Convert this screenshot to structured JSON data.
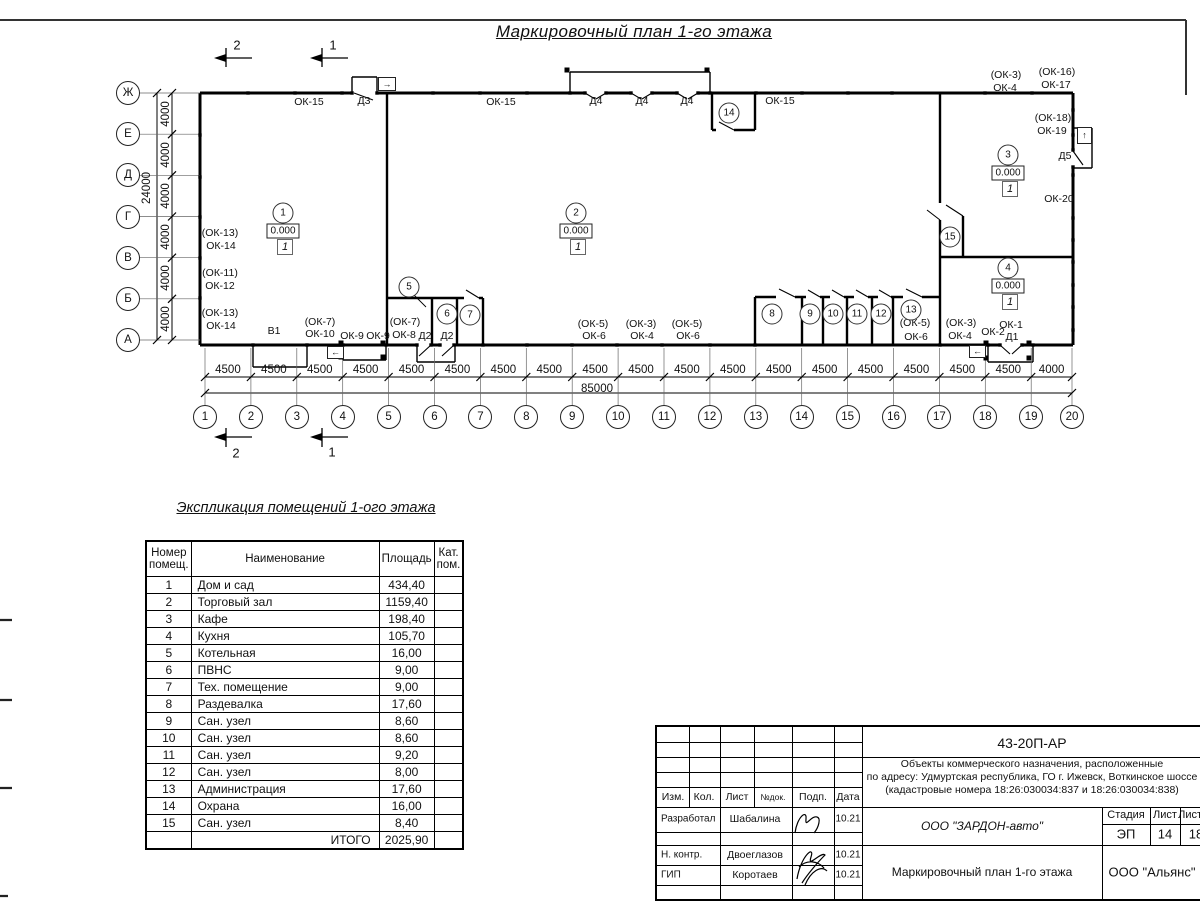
{
  "sheet": {
    "title": "Маркировочный план 1-го этажа"
  },
  "plan": {
    "section_marks": [
      {
        "label": "2",
        "x": 237,
        "y": 45
      },
      {
        "label": "1",
        "x": 333,
        "y": 45
      },
      {
        "label": "2",
        "x": 236,
        "y": 453
      },
      {
        "label": "1",
        "x": 332,
        "y": 452
      }
    ],
    "axes_left": [
      "Ж",
      "Е",
      "Д",
      "Г",
      "В",
      "Б",
      "А"
    ],
    "axes_bottom": [
      "1",
      "2",
      "3",
      "4",
      "5",
      "6",
      "7",
      "8",
      "9",
      "10",
      "11",
      "12",
      "13",
      "14",
      "15",
      "16",
      "17",
      "18",
      "19",
      "20"
    ],
    "dims_bottom": [
      "4500",
      "4500",
      "4500",
      "4500",
      "4500",
      "4500",
      "4500",
      "4500",
      "4500",
      "4500",
      "4500",
      "4500",
      "4500",
      "4500",
      "4500",
      "4500",
      "4500",
      "4500",
      "4000"
    ],
    "dim_total_bottom": "85000",
    "dims_left": [
      "4000",
      "4000",
      "4000",
      "4000",
      "4000",
      "4000"
    ],
    "dim_total_left": "24000",
    "rooms": [
      {
        "num": "1",
        "x": 283,
        "y": 213,
        "elev": "0.000",
        "fin": "1"
      },
      {
        "num": "2",
        "x": 576,
        "y": 213,
        "elev": "0.000",
        "fin": "1"
      },
      {
        "num": "3",
        "x": 1008,
        "y": 155,
        "elev": "0.000",
        "fin": "1"
      },
      {
        "num": "4",
        "x": 1008,
        "y": 268,
        "elev": "0.000",
        "fin": "1"
      },
      {
        "num": "5",
        "x": 409,
        "y": 287
      },
      {
        "num": "6",
        "x": 447,
        "y": 314
      },
      {
        "num": "7",
        "x": 470,
        "y": 315
      },
      {
        "num": "8",
        "x": 772,
        "y": 314
      },
      {
        "num": "9",
        "x": 810,
        "y": 314
      },
      {
        "num": "10",
        "x": 833,
        "y": 314
      },
      {
        "num": "11",
        "x": 857,
        "y": 314
      },
      {
        "num": "12",
        "x": 881,
        "y": 314
      },
      {
        "num": "13",
        "x": 911,
        "y": 310
      },
      {
        "num": "14",
        "x": 729,
        "y": 113
      },
      {
        "num": "15",
        "x": 950,
        "y": 237
      }
    ],
    "labels": [
      {
        "t": "ОК-15",
        "x": 309,
        "y": 102
      },
      {
        "t": "Д3",
        "x": 364,
        "y": 101
      },
      {
        "t": "ОК-15",
        "x": 501,
        "y": 102
      },
      {
        "t": "Д4",
        "x": 596,
        "y": 101
      },
      {
        "t": "Д4",
        "x": 642,
        "y": 101
      },
      {
        "t": "Д4",
        "x": 687,
        "y": 101
      },
      {
        "t": "ОК-15",
        "x": 780,
        "y": 101
      },
      {
        "t": "(ОК-3)",
        "x": 1006,
        "y": 75
      },
      {
        "t": "ОК-4",
        "x": 1005,
        "y": 88
      },
      {
        "t": "(ОК-16)",
        "x": 1057,
        "y": 72
      },
      {
        "t": "ОК-17",
        "x": 1056,
        "y": 85
      },
      {
        "t": "(ОК-18)",
        "x": 1053,
        "y": 118
      },
      {
        "t": "ОК-19",
        "x": 1052,
        "y": 131
      },
      {
        "t": "Д5",
        "x": 1065,
        "y": 156
      },
      {
        "t": "ОК-20",
        "x": 1059,
        "y": 199
      },
      {
        "t": "(ОК-13)",
        "x": 220,
        "y": 233
      },
      {
        "t": "ОК-14",
        "x": 221,
        "y": 246
      },
      {
        "t": "(ОК-11)",
        "x": 220,
        "y": 273
      },
      {
        "t": "ОК-12",
        "x": 220,
        "y": 286
      },
      {
        "t": "(ОК-13)",
        "x": 220,
        "y": 313
      },
      {
        "t": "ОК-14",
        "x": 221,
        "y": 326
      },
      {
        "t": "В1",
        "x": 274,
        "y": 331
      },
      {
        "t": "(ОК-7)",
        "x": 320,
        "y": 322
      },
      {
        "t": "ОК-10",
        "x": 320,
        "y": 334
      },
      {
        "t": "ОК-9",
        "x": 352,
        "y": 336
      },
      {
        "t": "ОК-9",
        "x": 378,
        "y": 336
      },
      {
        "t": "(ОК-7)",
        "x": 405,
        "y": 322
      },
      {
        "t": "ОК-8",
        "x": 404,
        "y": 335
      },
      {
        "t": "Д2",
        "x": 425,
        "y": 336
      },
      {
        "t": "Д2",
        "x": 447,
        "y": 336
      },
      {
        "t": "(ОК-5)",
        "x": 593,
        "y": 324
      },
      {
        "t": "ОК-6",
        "x": 594,
        "y": 336
      },
      {
        "t": "(ОК-3)",
        "x": 641,
        "y": 324
      },
      {
        "t": "ОК-4",
        "x": 642,
        "y": 336
      },
      {
        "t": "(ОК-5)",
        "x": 687,
        "y": 324
      },
      {
        "t": "ОК-6",
        "x": 688,
        "y": 336
      },
      {
        "t": "(ОК-5)",
        "x": 915,
        "y": 323
      },
      {
        "t": "ОК-6",
        "x": 916,
        "y": 337
      },
      {
        "t": "(ОК-3)",
        "x": 961,
        "y": 323
      },
      {
        "t": "ОК-4",
        "x": 960,
        "y": 336
      },
      {
        "t": "ОК-2",
        "x": 993,
        "y": 332
      },
      {
        "t": "ОК-1",
        "x": 1011,
        "y": 325
      },
      {
        "t": "Д1",
        "x": 1012,
        "y": 337
      }
    ],
    "arrow_boxes": [
      {
        "glyph": "→",
        "x": 378,
        "y": 77,
        "w": 16,
        "h": 12
      },
      {
        "glyph": "↑",
        "x": 1077,
        "y": 127,
        "w": 13,
        "h": 15
      },
      {
        "glyph": "←",
        "x": 327,
        "y": 346,
        "w": 15,
        "h": 11
      },
      {
        "glyph": "←",
        "x": 969,
        "y": 345,
        "w": 15,
        "h": 11
      }
    ]
  },
  "schedule": {
    "title": "Экспликация помещений 1-ого этажа",
    "headers": [
      "Номер помещ.",
      "Наименование",
      "Площадь",
      "Кат. пом."
    ],
    "rows": [
      [
        "1",
        "Дом и сад",
        "434,40",
        ""
      ],
      [
        "2",
        "Торговый зал",
        "1159,40",
        ""
      ],
      [
        "3",
        "Кафе",
        "198,40",
        ""
      ],
      [
        "4",
        "Кухня",
        "105,70",
        ""
      ],
      [
        "5",
        "Котельная",
        "16,00",
        ""
      ],
      [
        "6",
        "ПВНС",
        "9,00",
        ""
      ],
      [
        "7",
        "Тех. помещение",
        "9,00",
        ""
      ],
      [
        "8",
        "Раздевалка",
        "17,60",
        ""
      ],
      [
        "9",
        "Сан. узел",
        "8,60",
        ""
      ],
      [
        "10",
        "Сан. узел",
        "8,60",
        ""
      ],
      [
        "11",
        "Сан. узел",
        "9,20",
        ""
      ],
      [
        "12",
        "Сан. узел",
        "8,00",
        ""
      ],
      [
        "13",
        "Администрация",
        "17,60",
        ""
      ],
      [
        "14",
        "Охрана",
        "16,00",
        ""
      ],
      [
        "15",
        "Сан. узел",
        "8,40",
        ""
      ]
    ],
    "total_label": "ИТОГО",
    "total_value": "2025,90"
  },
  "titleblock": {
    "doc_number": "43-20П-АР",
    "description_lines": [
      "Объекты коммерческого назначения, расположенные",
      "по адресу: Удмуртская республика, ГО г. Ижевск, Воткинское шоссе",
      "(кадастровые номера 18:26:030034:837 и 18:26:030034:838)"
    ],
    "header_cells": [
      "Изм.",
      "Кол.",
      "Лист",
      "№док.",
      "Подп.",
      "Дата"
    ],
    "roles": [
      {
        "role": "Разработал",
        "name": "Шабалина",
        "date": "10.21"
      },
      {
        "role": "Н. контр.",
        "name": "Двоеглазов",
        "date": "10.21"
      },
      {
        "role": "ГИП",
        "name": "Коротаев",
        "date": "10.21"
      }
    ],
    "company": "ООО \"ЗАРДОН-авто\"",
    "stage_label": "Стадия",
    "sheet_label": "Лист",
    "sheets_label": "Листов",
    "stage": "ЭП",
    "sheet_num": "14",
    "sheets_total": "18",
    "drawing_title": "Маркировочный план 1-го этажа",
    "org": "ООО \"Альянс\""
  }
}
